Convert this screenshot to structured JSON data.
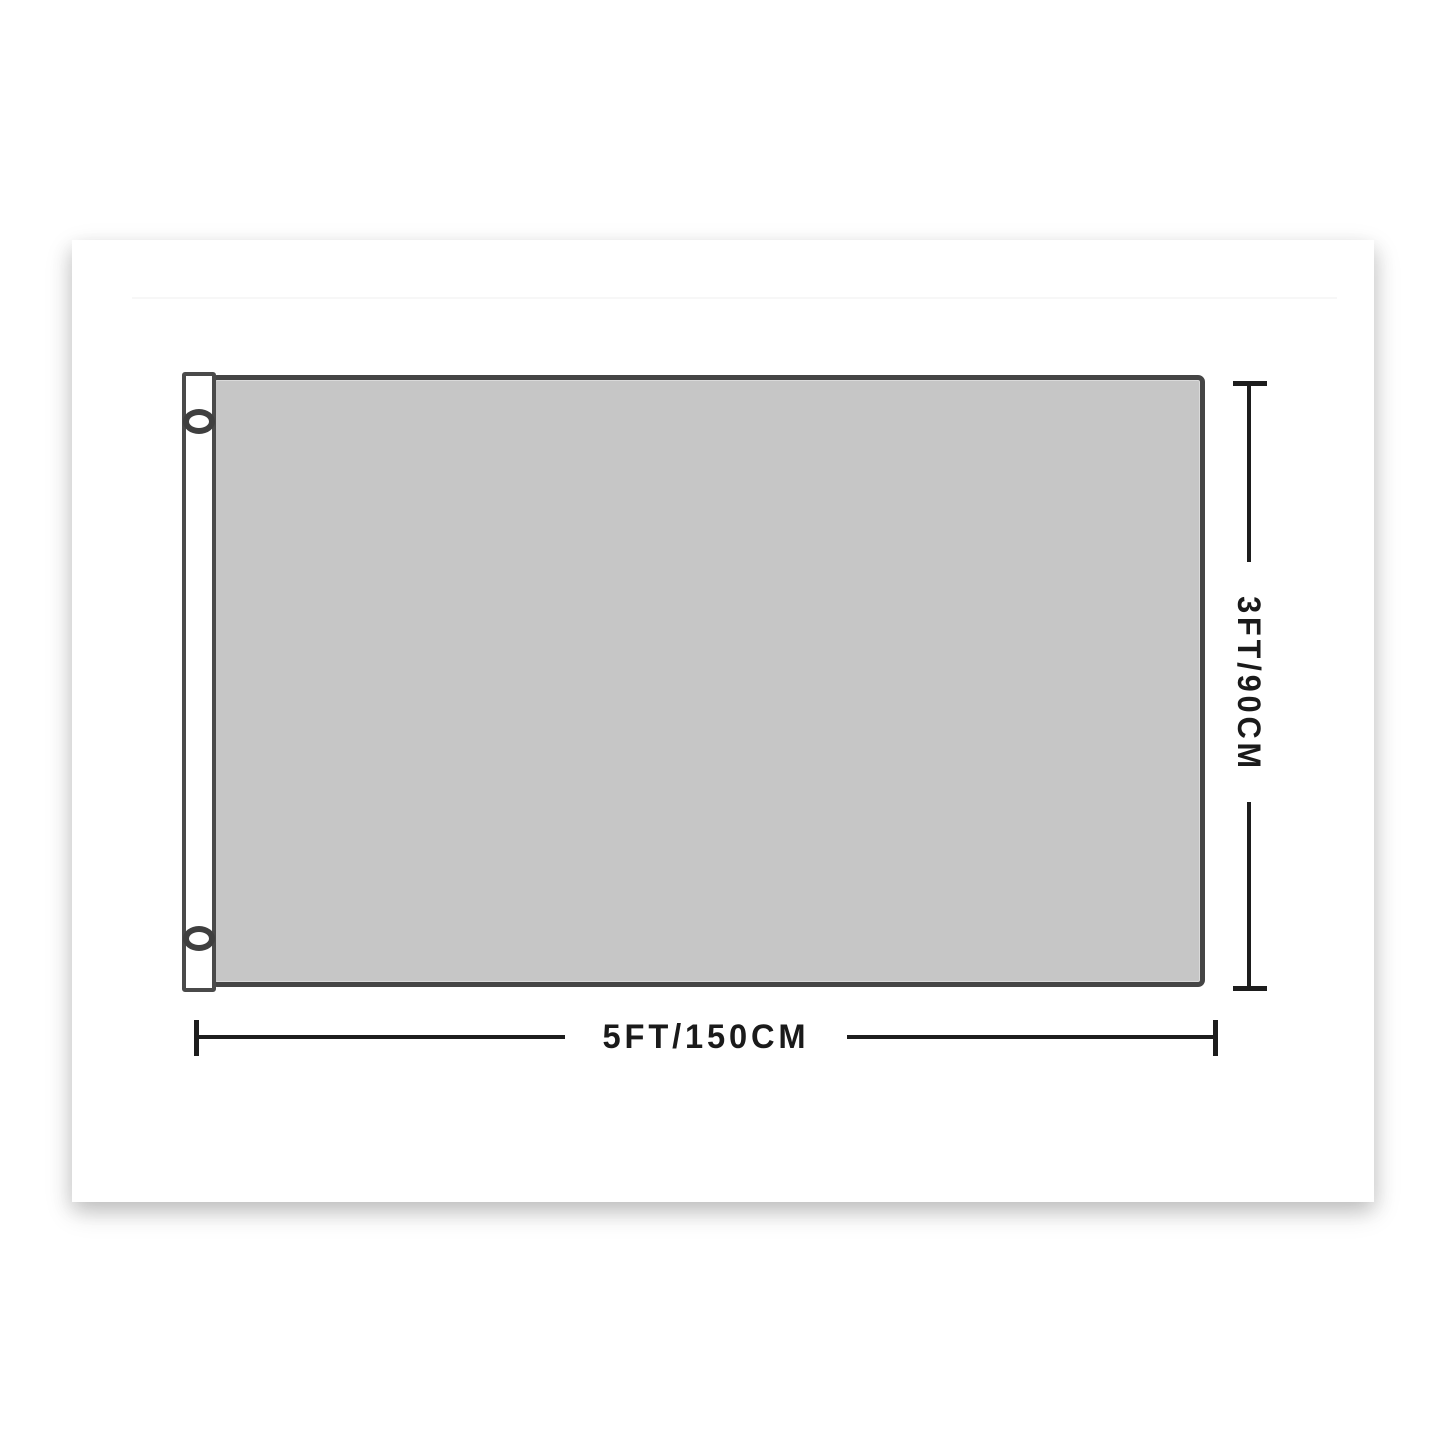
{
  "figure": {
    "type": "product-dimension-diagram",
    "subject": "blank flag with pole sleeve and two grommets",
    "flag_fill_color": "#c6c6c6",
    "flag_outline_color": "#454545",
    "sleeve_color": "#ffffff",
    "dimension_color": "#1d1d1d",
    "background_color": "#ffffff",
    "dimensions": {
      "height_label": "3FT/90CM",
      "width_label": "5FT/150CM"
    }
  }
}
